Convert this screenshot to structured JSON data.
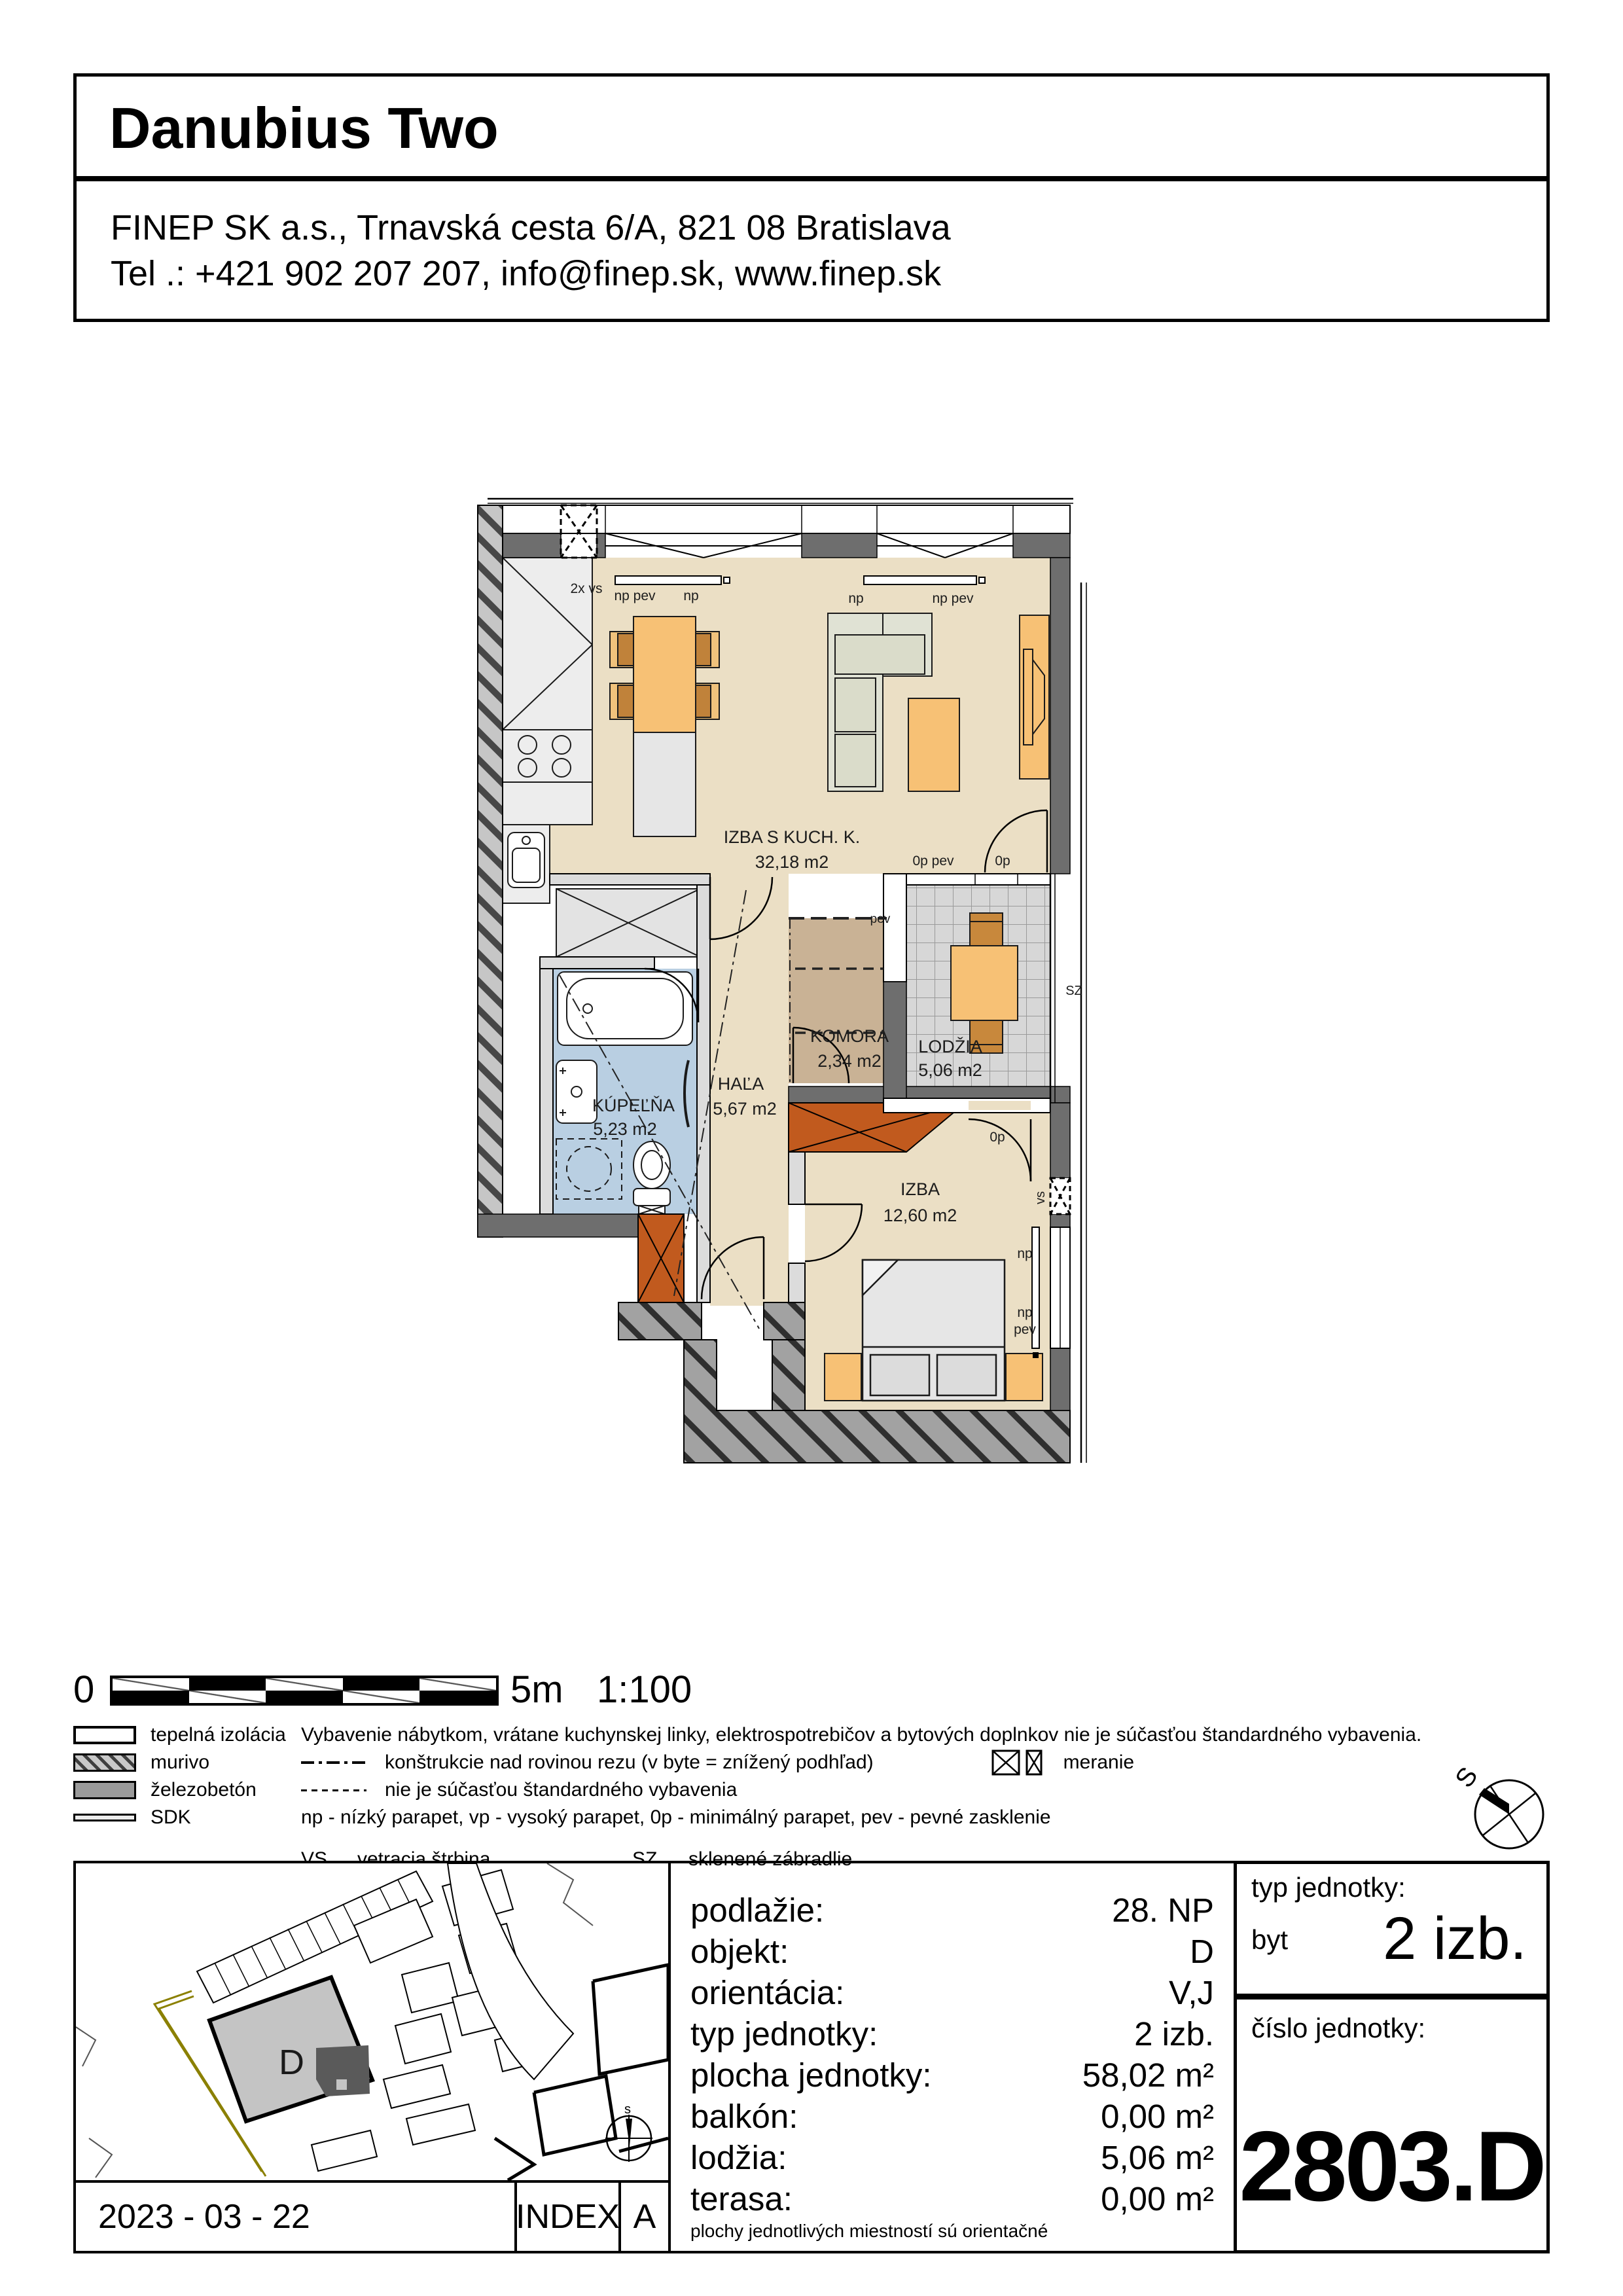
{
  "header": {
    "title": "Danubius Two",
    "address_line1": "FINEP SK a.s., Trnavská cesta 6/A, 821 08 Bratislava",
    "address_line2": "Tel .: +421 902 207 207, info@finep.sk, www.finep.sk"
  },
  "plan": {
    "rooms": [
      {
        "name": "IZBA S KUCH. K.",
        "area": "32,18 m2"
      },
      {
        "name": "KÚPEĽŇA",
        "area": "5,23 m2"
      },
      {
        "name": "HAĽA",
        "area": "5,67 m2"
      },
      {
        "name": "KOMORA",
        "area": "2,34 m2"
      },
      {
        "name": "LODŽIA",
        "area": "5,06 m2"
      },
      {
        "name": "IZBA",
        "area": "12,60 m2"
      }
    ],
    "ann": {
      "vs2x": "2x vs",
      "np_pev": "np pev",
      "np": "np",
      "pev": "pev",
      "op_pev": "0p pev",
      "op": "0p",
      "sz": "SZ",
      "vs": "vs"
    }
  },
  "scalebar": {
    "zero": "0",
    "five": "5m",
    "ratio": "1:100"
  },
  "legend": {
    "materials": [
      {
        "label": "tepelná izolácia"
      },
      {
        "label": "murivo"
      },
      {
        "label": "železobetón"
      },
      {
        "label": "SDK"
      }
    ],
    "note_equipment": "Vybavenie nábytkom, vrátane kuchynskej linky, elektrospotrebičov a bytových doplnkov nie je súčasťou štandardného vybavenia.",
    "note_structures": "konštrukcie nad rovinou rezu (v byte = znížený podhľad)",
    "note_meranie": "meranie",
    "note_nonstandard": "nie je súčasťou štandardného vybavenia",
    "note_parapets": "np - nízký parapet, vp - vysoký parapet, 0p - minimálný parapet, pev - pevné zasklenie",
    "abbr_vs_key": "VS",
    "abbr_vs_label": "vetracia štrbina",
    "abbr_sz_key": "SZ",
    "abbr_sz_label": "sklenené zábradlie"
  },
  "compass": {
    "north": "S",
    "map_north": "s"
  },
  "sitemap": {
    "building_label": "D"
  },
  "info": {
    "rows": [
      {
        "label": "podlažie:",
        "value": "28. NP"
      },
      {
        "label": "objekt:",
        "value": "D"
      },
      {
        "label": "orientácia:",
        "value": "V,J"
      },
      {
        "label": "typ jednotky:",
        "value": "2 izb."
      },
      {
        "label": "plocha jednotky:",
        "value": "58,02 m²"
      },
      {
        "label": "balkón:",
        "value": "0,00 m²"
      },
      {
        "label": "lodžia:",
        "value": "5,06 m²"
      },
      {
        "label": "terasa:",
        "value": "0,00 m²"
      }
    ],
    "footnote": "plochy jednotlivých miestností sú orientačné"
  },
  "unit": {
    "type_label": "typ jednotky:",
    "type_sub": "byt",
    "type_value": "2 izb.",
    "number_label": "číslo jednotky:",
    "number_value": "2803.D"
  },
  "footer": {
    "date": "2023 - 03 - 22",
    "index_label": "INDEX",
    "revision": "A"
  }
}
